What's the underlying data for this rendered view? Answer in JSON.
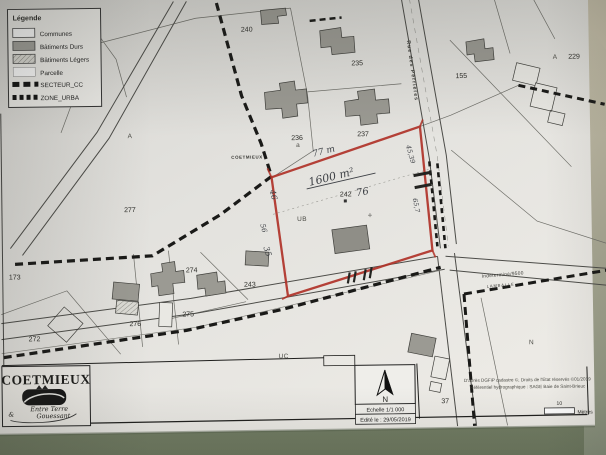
{
  "photo": {
    "paper_color": "#e4e3df",
    "table_color": "#75805f",
    "table_side_color": "#c9c2ac",
    "red_outline_color": "#b03228",
    "building_color": "#9b9a93"
  },
  "legend": {
    "title": "Légende",
    "items": [
      "Communes",
      "Bâtiments Durs",
      "Bâtiments Légers",
      "Parcelle",
      "SECTEUR_CC",
      "ZONE_URBA"
    ]
  },
  "map": {
    "place_label": "COETMIEUX",
    "street_label": "Rue des Perrières",
    "road_label": "Indeterminé/9500",
    "road_label_sub": "LAMBALLE",
    "parcel_numbers": {
      "n240": "240",
      "n235": "235",
      "n236": "236",
      "n237": "237",
      "n277": "277",
      "n173": "173",
      "n274": "274",
      "n243": "243",
      "n275": "275",
      "n276": "276",
      "n272": "272",
      "n155": "155",
      "n229": "229",
      "n37": "37",
      "n242": "242"
    },
    "zone_labels": {
      "a_left": "A",
      "a_small": "a",
      "a_right": "A",
      "ub": "UB",
      "uc": "UC",
      "n_zone": "N"
    },
    "handwriting": {
      "top_side": "77 m",
      "area": "1600 m²",
      "mid": "76",
      "left_top": "46",
      "left_mid": "56",
      "left_bottom": "35",
      "right_top": "45,39",
      "right_mid": "65,7"
    }
  },
  "titleblock": {
    "commune": "COETMIEUX",
    "ampersand": "&",
    "logo_line1": "Entre Terre",
    "logo_line2": "Gouessant"
  },
  "footer": {
    "north_label": "N",
    "scale_text": "Echelle 1/1 000",
    "edition_text": "Edité le : 29/05/2019",
    "credits_line1": "D'après DGFiP cadastre ©, Droits de l'Etat réservés ©01/2019",
    "credits_line2": "Référentiel hydrographique : SAGE Baie de Saint-Brieuc",
    "scalebar_value": "10",
    "scalebar_unit": "Mètres"
  }
}
